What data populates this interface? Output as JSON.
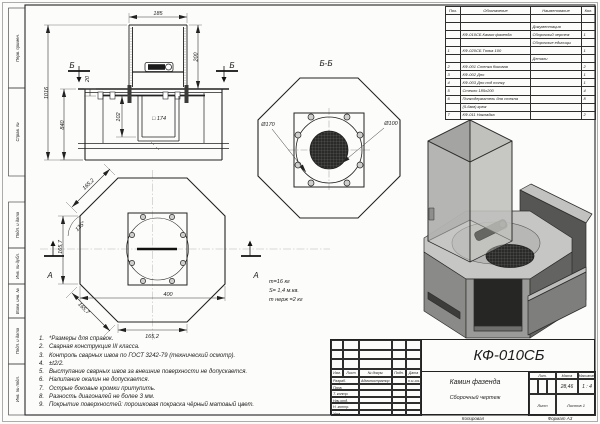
{
  "sheet": {
    "copied_label": "Копировал",
    "format_label": "Формат А3"
  },
  "margin": {
    "labels": [
      "Перв. примен.",
      "Справ. №",
      "Подп. и дата",
      "Инв. № дубл.",
      "Взам. инв. №",
      "Подп. и дата",
      "Инв. № подл."
    ]
  },
  "parts_table": {
    "headers": [
      "Поз.",
      "Обозначение",
      "Наименование",
      "Кол."
    ],
    "rows": [
      {
        "pos": "",
        "desig": "",
        "name": "",
        "qty": ""
      },
      {
        "pos": "",
        "desig": "",
        "name": "Документация",
        "qty": ""
      },
      {
        "pos": "",
        "desig": "КФ-010СБ Камин фазенда",
        "name": "Сборочный чертеж",
        "qty": "1"
      },
      {
        "pos": "",
        "desig": "",
        "name": "Сборочные единицы",
        "qty": ""
      },
      {
        "pos": "1",
        "desig": "КФ-020СБ Топка 100",
        "name": "",
        "qty": "1"
      },
      {
        "pos": "",
        "desig": "",
        "name": "Детали",
        "qty": ""
      },
      {
        "pos": "2",
        "desig": "КФ-001 Стенка боковая",
        "name": "",
        "qty": "2"
      },
      {
        "pos": "3",
        "desig": "КФ-002 Дно",
        "name": "",
        "qty": "1"
      },
      {
        "pos": "4",
        "desig": "КФ-003 Дно под топку",
        "name": "",
        "qty": "1"
      },
      {
        "pos": "5",
        "desig": "Стекло 185х200",
        "name": "",
        "qty": "4"
      },
      {
        "pos": "6",
        "desig": "Полкодержатель для стекла",
        "name": "",
        "qty": "8"
      },
      {
        "pos": "",
        "desig": "(5-6мм) крюк",
        "name": "",
        "qty": ""
      },
      {
        "pos": "7",
        "desig": "КФ-011 Накладка",
        "name": "",
        "qty": "2"
      }
    ]
  },
  "title_block": {
    "doc_number": "КФ-010СБ",
    "name": "Камин фазенда",
    "doc_type": "Сборочный чертеж",
    "cols": {
      "izm": "Изм.",
      "list": "Лист",
      "doc": "№ докум.",
      "podp": "Подп.",
      "data": "Дата"
    },
    "roles": [
      {
        "label": "Разраб.",
        "value": "Администратор",
        "date": "8.11.2013"
      },
      {
        "label": "Пров.",
        "value": "",
        "date": ""
      },
      {
        "label": "Т. контр.",
        "value": "",
        "date": ""
      },
      {
        "label": "Нач.отд.",
        "value": "",
        "date": ""
      },
      {
        "label": "Н. контр.",
        "value": "",
        "date": ""
      },
      {
        "label": "Утв.",
        "value": "",
        "date": ""
      }
    ],
    "lit_label": "Лит.",
    "mass_label": "Масса",
    "scale_label": "Масштаб",
    "mass": "28,46",
    "scale": "1 : 4",
    "sheet_label": "Лист",
    "sheets_label": "Листов",
    "sheets_value": "1"
  },
  "notes": {
    "items": [
      "*Размеры для справок.",
      "Сварная конструкция III класса.",
      "Контроль сварных швов по ГОСТ 3242-79 (технический осмотр).",
      "±t2/2.",
      "Выступание сварных швов за внешние поверхности не допускается.",
      "Налипание окалин не допускается.",
      "Острые боковые кромки притупить.",
      "Разность диагоналей не более 3 мм.",
      "Покрытие поверхностей: порошковая покраска чёрный матовый цвет."
    ]
  },
  "views": {
    "front": {
      "dim_width": "185",
      "dim_chimney_h": "200",
      "dim_total_h": "1016",
      "dim_body_h": "840",
      "dim_offset": "20",
      "dim_inner": "102",
      "dim_square": "□ 174",
      "section_label": "Б"
    },
    "section_bb": {
      "title": "Б-Б",
      "dia_outer": "Ø170",
      "dia_inner": "Ø100"
    },
    "bottom": {
      "edge_top": "165,2",
      "angle": "135°",
      "edge_left": "165,7",
      "edge_bottom_left": "165,7",
      "width": "400",
      "edge_bottom": "165,2",
      "section_label": "А"
    },
    "mass_note": {
      "line1": "m=16 кг",
      "line2": "S= 1,4 м.кв.",
      "line3": "m нерж =2 кг"
    }
  },
  "colors": {
    "line": "#222222",
    "centerline": "#999999",
    "iso_light": "#c6c6c4",
    "iso_mid": "#8a8a88",
    "iso_dark": "#2b2b29"
  }
}
